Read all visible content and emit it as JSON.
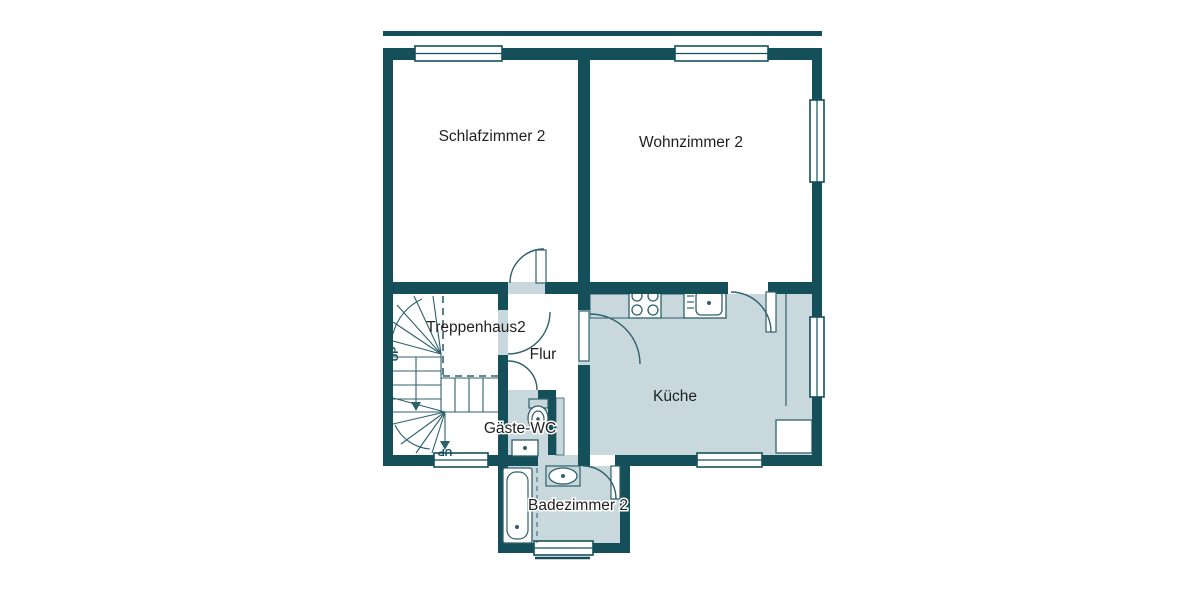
{
  "colors": {
    "wall": "#15505A",
    "room_fill": "#C8D8DC",
    "line": "#2E616B",
    "text": "#1F1F1F",
    "background": "#FFFFFF"
  },
  "rooms": {
    "schlafzimmer": {
      "label": "Schlafzimmer 2"
    },
    "wohnzimmer": {
      "label": "Wohnzimmer 2"
    },
    "treppenhaus": {
      "label": "Treppenhaus2"
    },
    "flur": {
      "label": "Flur"
    },
    "gaeste_wc": {
      "label": "Gäste-WC"
    },
    "kueche": {
      "label": "Küche"
    },
    "badezimmer": {
      "label": "Badezimmer 2"
    }
  },
  "stairs": {
    "up_label_1": "UP",
    "up_label_2": "UP"
  },
  "icons": {
    "stove": "stove-icon",
    "kitchen_sink": "kitchen-sink-icon",
    "toilet": "toilet-icon",
    "wc_sink": "wc-sink-icon",
    "bathtub": "bathtub-icon",
    "bath_sink": "bath-sink-icon",
    "appliance": "appliance-icon",
    "stair_arrows": "stair-direction-arrow-icon"
  }
}
